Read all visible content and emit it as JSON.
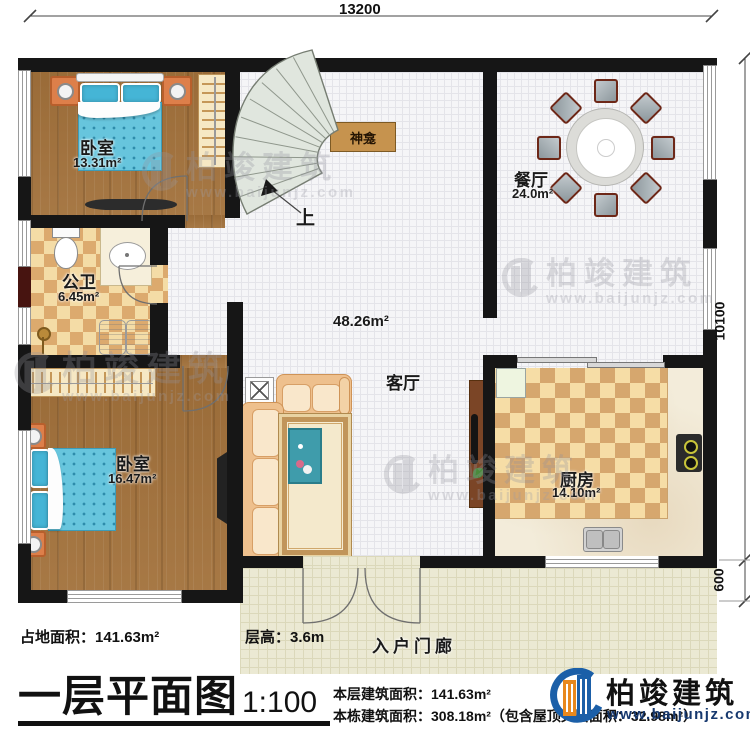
{
  "plan": {
    "rooms": {
      "bedroom1": {
        "name": "卧室",
        "area": "13.31m²"
      },
      "bathroom": {
        "name": "公卫",
        "area": "6.45m²"
      },
      "bedroom2": {
        "name": "卧室",
        "area": "16.47m²"
      },
      "living": {
        "name": "客厅",
        "area": "48.26m²"
      },
      "dining": {
        "name": "餐厅",
        "area": "24.0m²"
      },
      "kitchen": {
        "name": "厨房",
        "area": "14.10m²"
      },
      "shrine": {
        "name": "神龛"
      },
      "porch": {
        "name": "入户门廊"
      }
    },
    "stairs": {
      "direction_label": "上"
    },
    "dimensions": {
      "top": "13200",
      "right": "10100",
      "right_lower": "600"
    }
  },
  "footer": {
    "site_area_label": "占地面积：141.63m²",
    "floor_height_label": "层高：3.6m",
    "title": "一层平面图",
    "scale": "1:100",
    "this_floor_area": "本层建筑面积：141.63m²",
    "building_area": "本栋建筑面积：308.18m²（包含屋顶夹层面积：32.98m²）"
  },
  "brand": {
    "name": "柏竣建筑",
    "website": "www.baijunjz.com"
  },
  "watermark": {
    "name": "柏竣建筑",
    "website": "www.baijunjz.com"
  },
  "colors": {
    "wall": "#161616",
    "wood_floor": "#a2713b",
    "bed_blue": "#67c5dd",
    "logo_blue": "#1b5fa8",
    "logo_orange": "#e8881d",
    "stair_fill": "#e0e6de"
  }
}
